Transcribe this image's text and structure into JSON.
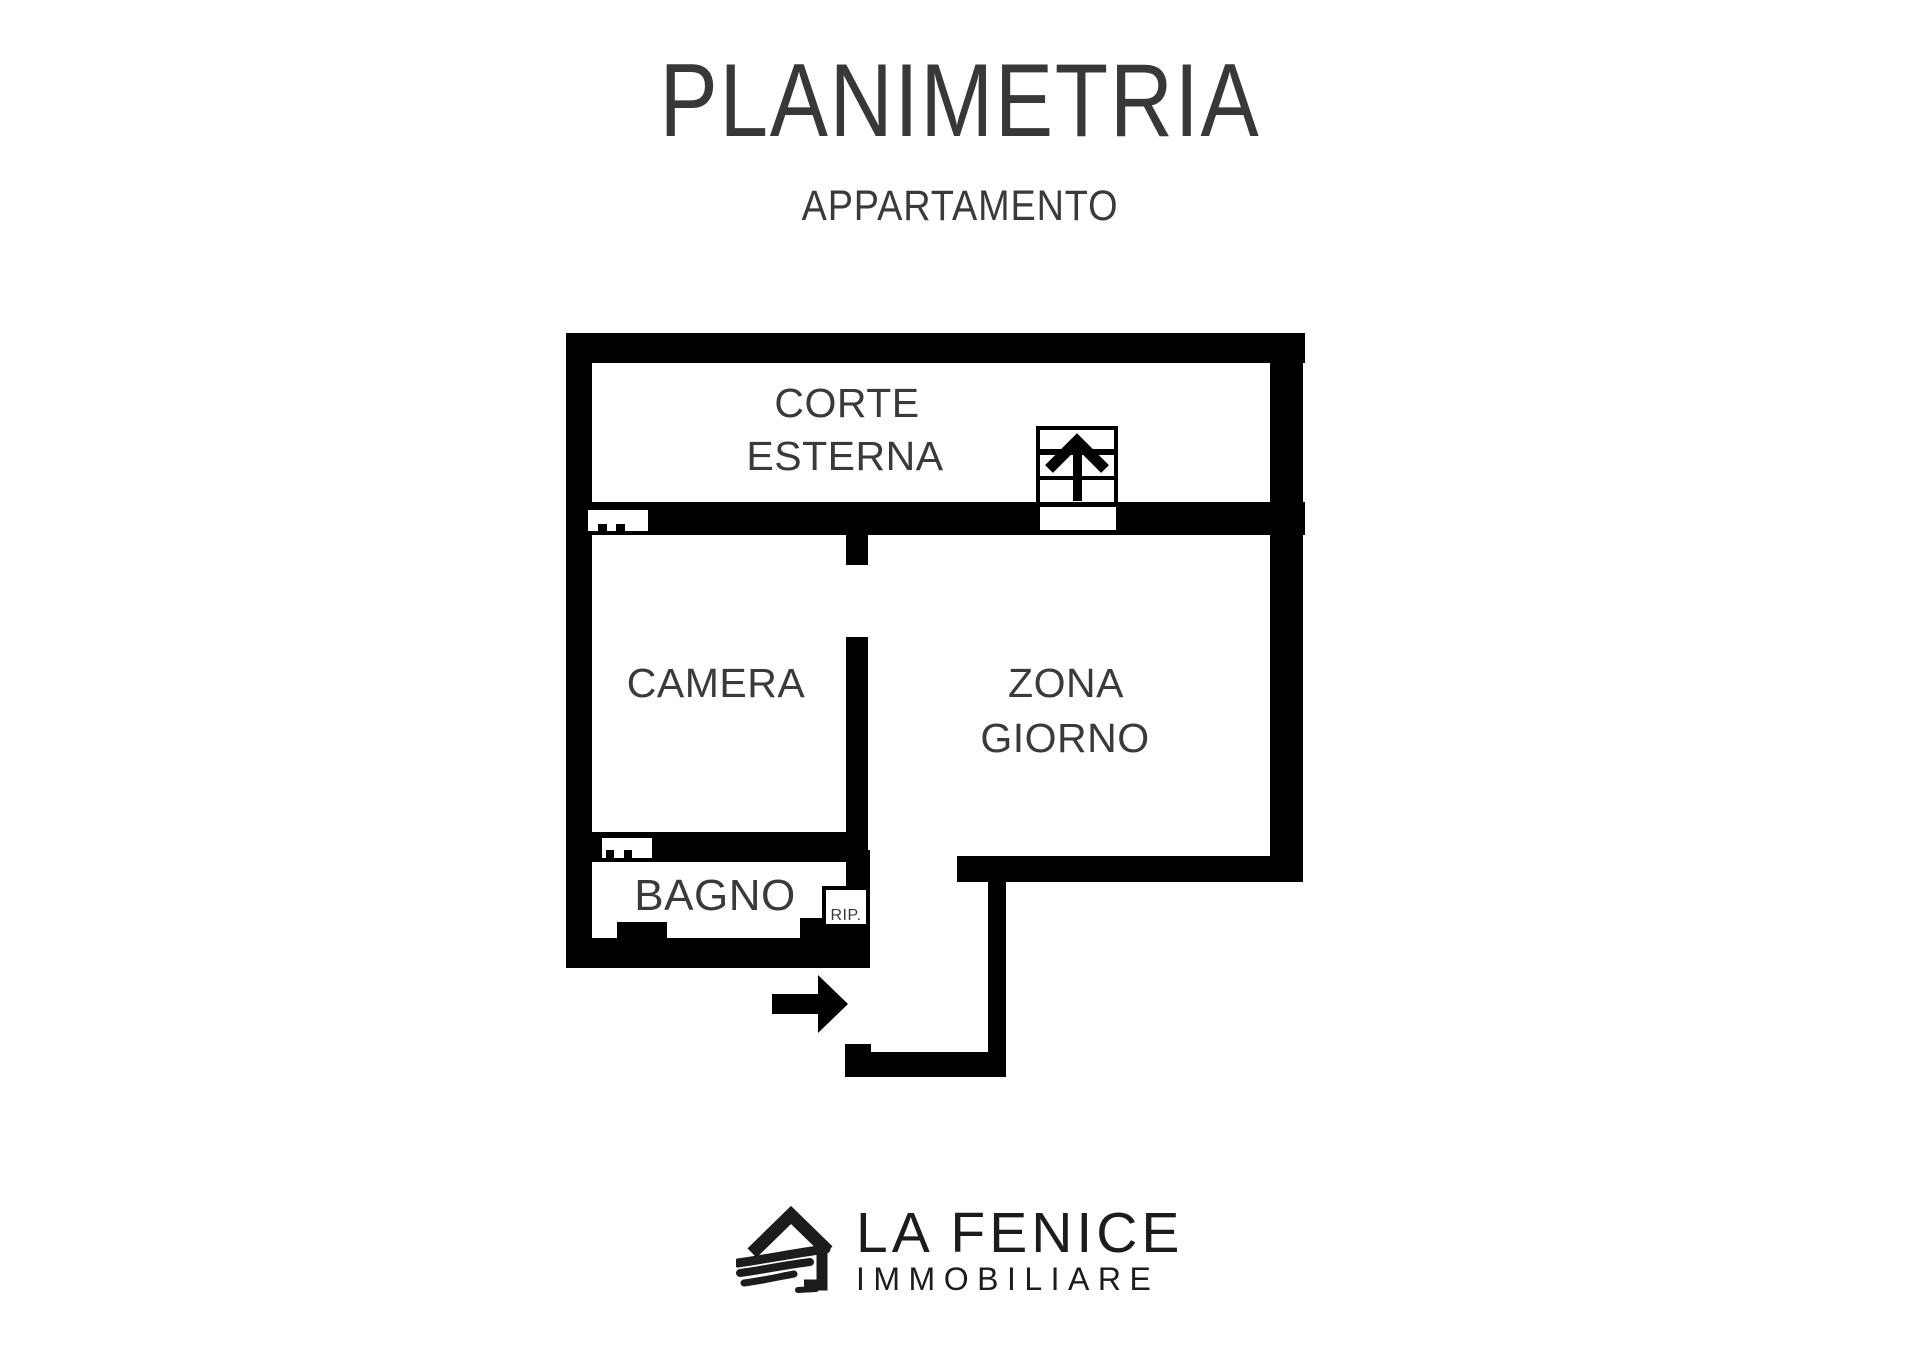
{
  "header": {
    "title": "PLANIMETRIA",
    "subtitle": "APPARTAMENTO"
  },
  "floor_plan": {
    "labels": {
      "corte_line1": "CORTE",
      "corte_line2": "ESTERNA",
      "camera": "CAMERA",
      "zona_line1": "ZONA",
      "zona_line2": "GIORNO",
      "bagno": "BAGNO",
      "ripostiglio": "RIP."
    },
    "icons": {
      "stairs": "stairs-up-arrow-icon",
      "entrance": "entrance-arrow-icon",
      "brand": "house-wing-logo-icon"
    },
    "colors": {
      "wall": "#000000",
      "label": "#3a3a3c",
      "brand": "#1c1c1e"
    }
  },
  "footer": {
    "brand_name": "LA FENICE",
    "brand_subtitle": "IMMOBILIARE"
  }
}
